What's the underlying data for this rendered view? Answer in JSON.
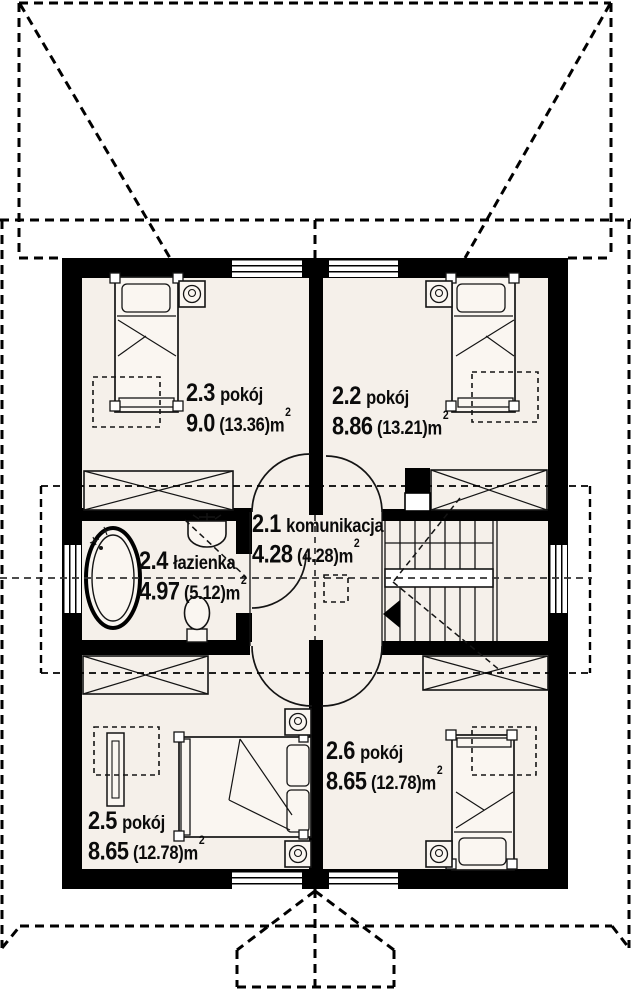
{
  "colors": {
    "paper": "#ffffff",
    "wall": "#000000",
    "floor": "#f5f0ea",
    "line": "#141414",
    "furn": "#faf6f1"
  },
  "area_superscript": "2",
  "rooms": [
    {
      "id": "2.3",
      "name": "pokój",
      "area": "9.0",
      "area_total": "(13.36)",
      "unit": "m"
    },
    {
      "id": "2.2",
      "name": "pokój",
      "area": "8.86",
      "area_total": "(13.21)",
      "unit": "m"
    },
    {
      "id": "2.1",
      "name": "komunikacja",
      "area": "4.28",
      "area_total": "(4.28)",
      "unit": "m"
    },
    {
      "id": "2.4",
      "name": "łazienka",
      "area": "4.97",
      "area_total": "(5.12)",
      "unit": "m"
    },
    {
      "id": "2.5",
      "name": "pokój",
      "area": "8.65",
      "area_total": "(12.78)",
      "unit": "m"
    },
    {
      "id": "2.6",
      "name": "pokój",
      "area": "8.65",
      "area_total": "(12.78)",
      "unit": "m"
    }
  ]
}
